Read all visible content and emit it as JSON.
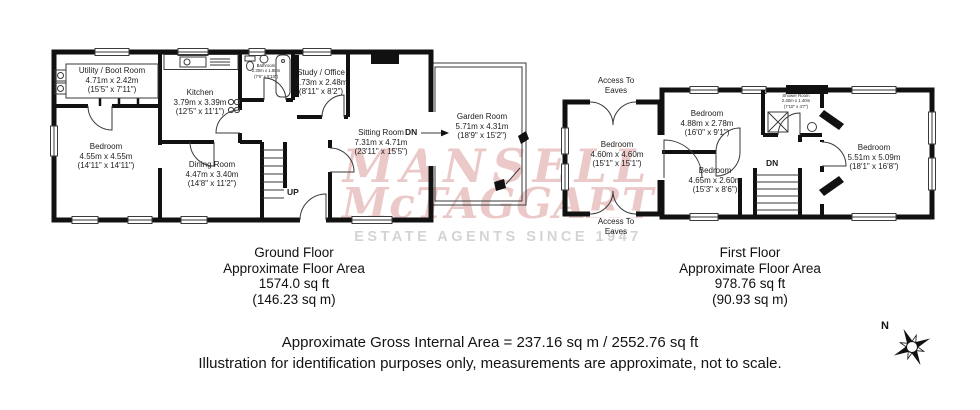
{
  "watermark": {
    "line1": "MANSELL",
    "line2": "McTAGGART",
    "tagline": "ESTATE AGENTS SINCE 1947",
    "color": "#ecc9c9",
    "tagline_color": "#d4d4d4"
  },
  "compass": {
    "north_label": "N"
  },
  "ground_floor": {
    "caption": {
      "title": "Ground Floor",
      "subtitle": "Approximate Floor Area",
      "area_imperial": "1574.0 sq ft",
      "area_metric": "(146.23 sq m)"
    },
    "stair_label": "UP",
    "garden_step_label": "DN",
    "rooms": {
      "utility": {
        "name": "Utility / Boot Room",
        "metric": "4.71m x 2.42m",
        "imperial": "(15'5\" x 7'11\")"
      },
      "bedroom": {
        "name": "Bedroom",
        "metric": "4.55m x 4.55m",
        "imperial": "(14'11\" x 14'11\")"
      },
      "kitchen": {
        "name": "Kitchen",
        "metric": "3.79m x 3.39m",
        "imperial": "(12'5\" x 11'1\")"
      },
      "dining": {
        "name": "Dining Room",
        "metric": "4.47m x 3.40m",
        "imperial": "(14'8\" x 11'2\")"
      },
      "bathroom": {
        "name": "Bathroom",
        "metric": "2.30m x 1.80m",
        "imperial": "(7'6\" x 5'10\")"
      },
      "study": {
        "name": "Study / Office",
        "metric": "2.73m x 2.48m",
        "imperial": "(8'11\" x 8'2\")"
      },
      "sitting": {
        "name": "Sitting Room",
        "metric": "7.31m x 4.71m",
        "imperial": "(23'11\" x 15'5\")"
      },
      "garden": {
        "name": "Garden Room",
        "metric": "5.71m x 4.31m",
        "imperial": "(18'9\" x 15'2\")"
      }
    }
  },
  "first_floor": {
    "caption": {
      "title": "First Floor",
      "subtitle": "Approximate Floor Area",
      "area_imperial": "978.76 sq ft",
      "area_metric": "(90.93 sq m)"
    },
    "stair_label": "DN",
    "access_top": "Access To Eaves",
    "access_bottom": "Access To Eaves",
    "rooms": {
      "bedroom_left": {
        "name": "Bedroom",
        "metric": "4.60m x 4.60m",
        "imperial": "(15'1\" x 15'1\")"
      },
      "bedroom_mid_top": {
        "name": "Bedroom",
        "metric": "4.88m x 2.78m",
        "imperial": "(16'0\" x 9'1\")"
      },
      "bedroom_mid_bottom": {
        "name": "Bedroom",
        "metric": "4.65m x 2.60m",
        "imperial": "(15'3\" x 8'6\")"
      },
      "shower": {
        "name": "Shower Room",
        "metric": "2.40m x 1.40m",
        "imperial": "(7'10\" x 4'7\")"
      },
      "bedroom_right": {
        "name": "Bedroom",
        "metric": "5.51m x 5.09m",
        "imperial": "(18'1\" x 16'8\")"
      }
    }
  },
  "footer": {
    "line1": "Approximate Gross Internal Area = 237.16 sq m / 2552.76 sq ft",
    "line2": "Illustration for identification purposes only, measurements are approximate, not to scale."
  }
}
